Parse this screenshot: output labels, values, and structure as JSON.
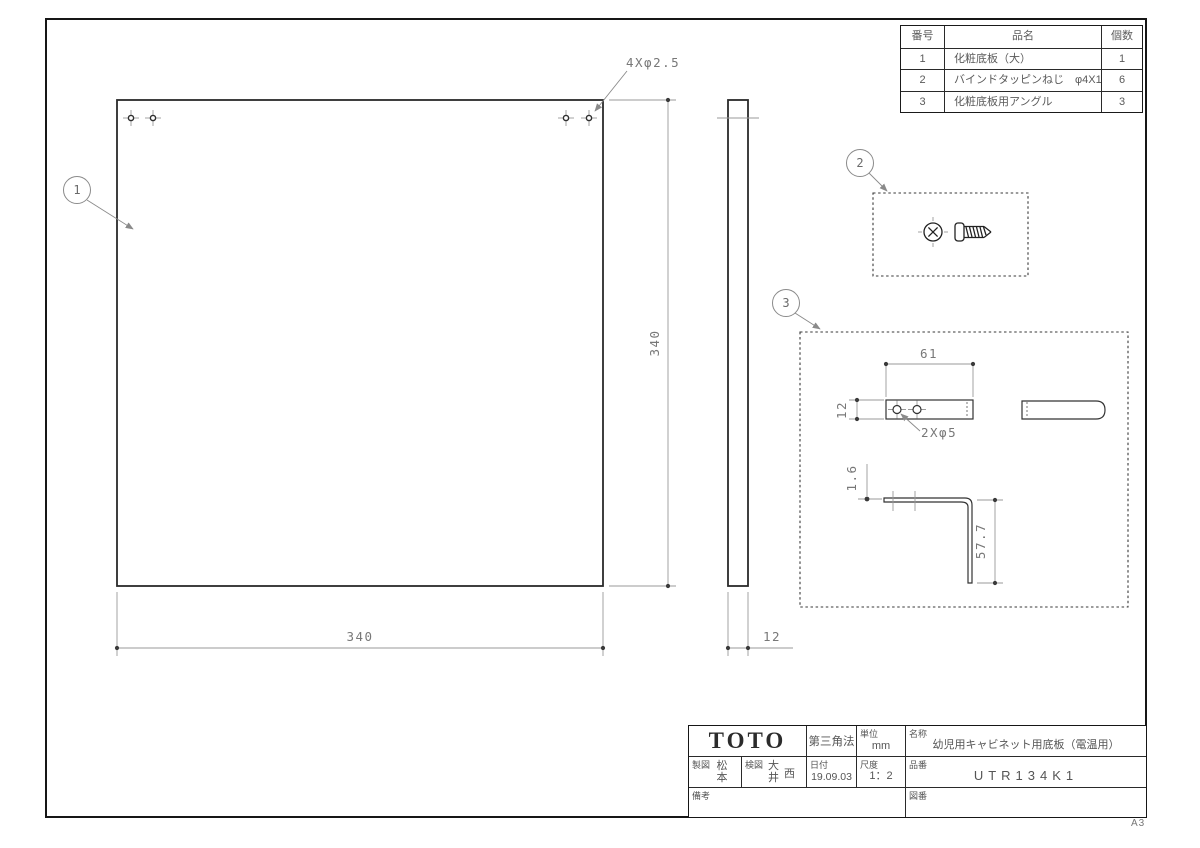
{
  "frame": {
    "sheet_size": "A3"
  },
  "parts_table": {
    "headers": {
      "no": "番号",
      "name": "品名",
      "qty": "個数"
    },
    "rows": [
      {
        "no": "1",
        "name": "化粧底板（大）",
        "qty": "1"
      },
      {
        "no": "2",
        "name": "バインドタッピンねじ　φ4X10",
        "qty": "6"
      },
      {
        "no": "3",
        "name": "化粧底板用アングル",
        "qty": "3"
      }
    ]
  },
  "balloons": {
    "b1": "1",
    "b2": "2",
    "b3": "3"
  },
  "dims": {
    "main_width": "340",
    "main_height": "340",
    "thickness": "12",
    "main_holes": "4Xφ2.5",
    "angle_length": "61",
    "angle_width": "12",
    "angle_holes": "2Xφ5",
    "angle_thickness": "1.6",
    "angle_leg_height": "57.7"
  },
  "title_block": {
    "logo": "TOTO",
    "projection": "第三角法",
    "unit": {
      "label": "単位",
      "value": "mm"
    },
    "name": {
      "label": "名称",
      "value": "幼児用キャビネット用底板（電温用）"
    },
    "drafter": {
      "label": "製図",
      "value": "松本"
    },
    "checker": {
      "label": "検図",
      "value": "大井",
      "value2": "西"
    },
    "date": {
      "label": "日付",
      "value": "19.09.03"
    },
    "scale": {
      "label": "尺度",
      "value": "1：2"
    },
    "part_no": {
      "label": "品番",
      "value": "UTR134K1"
    },
    "remarks": {
      "label": "備考"
    },
    "drawing_no": {
      "label": "図番"
    }
  }
}
